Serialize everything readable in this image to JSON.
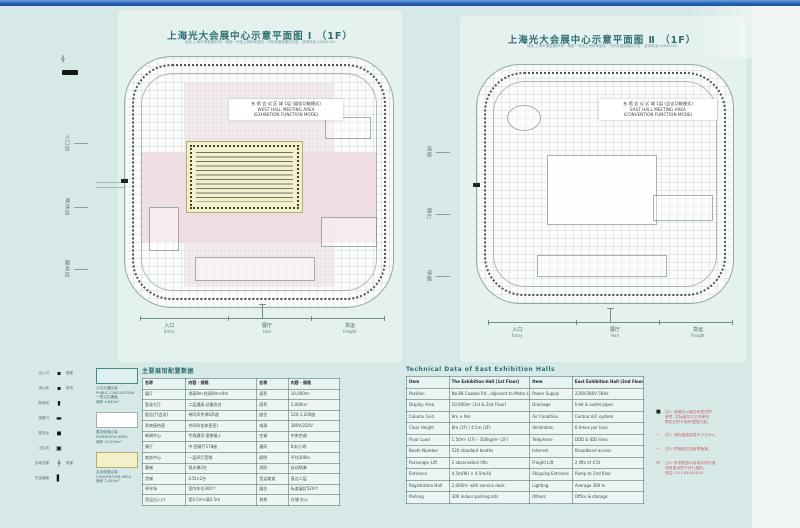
{
  "window": {
    "corner_label": "EF"
  },
  "colors": {
    "paper": "#d7e9e7",
    "title_teal": "#2e6f74",
    "pink_zone": "#eddbe2",
    "yellow_hall": "#f3f0cc",
    "table_line": "#4f7e7e",
    "note_red": "#c4606e",
    "titlebar_blue": "#2b63b5"
  },
  "icons": {
    "scale_bar": "scale-bar",
    "survey_mark": "╬"
  },
  "plans": {
    "left": {
      "title": "上海光大会展中心示意平面图 Ⅰ （1F）",
      "subtitle": "地址:上海市漕宝路88号 · 地铁一号线上海体育馆站 · 内环线漕溪路出口处 · 咨询电话 64842500",
      "note_lines": [
        "东 馆 会 议 区 域 1层 (展览功能模式)",
        "WEST HALL  MEETING AREA",
        "(EXHIBITION FUNCTION MODE)"
      ],
      "axis_labels": [
        {
          "cn": "入口",
          "en": "Entry"
        },
        {
          "cn": "展厅",
          "en": "Hall"
        },
        {
          "cn": "货运",
          "en": "Freight"
        }
      ]
    },
    "right": {
      "title": "上海光大会展中心示意平面图 Ⅱ （1F）",
      "subtitle": "地址:上海市漕宝路88号 · 地铁一号线上海体育馆站 · 内环线漕溪路出口处 · 咨询电话 64842500",
      "note_lines": [
        "东 馆 会 议 区 域 1层 (会议功能模式)",
        "EAST HALL  MEETING AREA",
        "(CONVENTION FUNCTION MODE)"
      ],
      "axis_labels": [
        {
          "cn": "入口",
          "en": "Entry"
        },
        {
          "cn": "展厅",
          "en": "Hall"
        },
        {
          "cn": "货运",
          "en": "Freight"
        }
      ]
    }
  },
  "side_labels": {
    "left_margin": [
      "入口区",
      "通道区",
      "服务区"
    ],
    "between": [
      "连廊",
      "展厅",
      "道路"
    ]
  },
  "legend": {
    "rows": [
      {
        "l": "出入口",
        "s": "▪",
        "r": "楼梯"
      },
      {
        "l": "消火栓",
        "s": "▪",
        "r": "卷帘"
      },
      {
        "l": "配电间",
        "s": "▮",
        "r": ""
      },
      {
        "l": "疏散口",
        "s": "▬",
        "r": ""
      },
      {
        "l": "服务台",
        "s": "◼",
        "r": ""
      },
      {
        "l": "卫生间",
        "s": "▣",
        "r": ""
      },
      {
        "l": "自动扶梯",
        "s": "┼",
        "r": "电梯"
      },
      {
        "l": "货运通道",
        "s": "▌",
        "r": ""
      }
    ],
    "swatches": [
      {
        "color": "#e0f0ee",
        "border": "#3f8a8a",
        "lines": [
          "公共交通区域",
          "PUBLIC CIRCULATION",
          "一层公共通道",
          "面积 4,600m²"
        ]
      },
      {
        "color": "#fcfdfc",
        "border": "#9fb0ae",
        "lines": [
          "展览使用区域",
          "EXHIBITION AREA",
          "面积 10,000m²"
        ]
      },
      {
        "color": "#f3f0cb",
        "border": "#b5ac6c",
        "lines": [
          "会议使用区域",
          "CONVENTION AREA",
          "面积 2,400m²"
        ]
      }
    ]
  },
  "mid_table": {
    "title": "主要展馆配置数据",
    "col_widths": [
      22,
      36,
      16,
      26
    ],
    "header": [
      "名称",
      "内容 · 规格",
      "名称",
      "内容 · 规格"
    ],
    "rows": [
      [
        "展厅",
        "净高8m·柱网9m×9m",
        "面积",
        "10,000m²"
      ],
      [
        "登录大厅",
        "二层通高·总服务台",
        "面积",
        "2,000m²"
      ],
      [
        "报告厅(会议)",
        "带同声传译6声道",
        "座位",
        "120-1,200座"
      ],
      [
        "贵宾接待室",
        "共6间(含休息室)",
        "电源",
        "380V/220V"
      ],
      [
        "新闻中心",
        "专线通讯·宽带接入",
        "空调",
        "中央空调"
      ],
      [
        "餐厅",
        "中·西餐厅178座",
        "通风",
        "6次/小时"
      ],
      [
        "商务中心",
        "一层序厅西侧",
        "照明",
        "平均300lx"
      ],
      [
        "客梯",
        "观光梯2台",
        "消防",
        "自动喷淋"
      ],
      [
        "货梯",
        "4.5t×2台",
        "货运坡道",
        "直达二层"
      ],
      [
        "停车场",
        "室内车位300个",
        "展位",
        "标准展位520个"
      ],
      [
        "货运出入口",
        "宽4.5m×高4.5m",
        "其他",
        "仓储·办公"
      ]
    ]
  },
  "right_table": {
    "title": "Technical Data of East Exhibition Halls",
    "col_widths": [
      18,
      34,
      18,
      30
    ],
    "header": [
      "Item",
      "The Exhibition Hall (1st Floor)",
      "Item",
      "East Exhibition Hall (2nd Floor)"
    ],
    "rows": [
      [
        "Position",
        "No.88 Caobao Rd., adjacent to Metro Line 1",
        "Power Supply",
        "220V/380V 50Hz"
      ],
      [
        "Display Area",
        "10,000m² (1st & 2nd Floor)",
        "Drainage",
        "Inlet & outlet pipes"
      ],
      [
        "Column Grid",
        "9m × 9m",
        "Air Condition",
        "Central A/C system"
      ],
      [
        "Clear Height",
        "8m (1F) / 4.5m (2F)",
        "Ventilation",
        "6 times per hour"
      ],
      [
        "Floor Load",
        "1.5t/m² (1F) · 350kg/m² (2F)",
        "Telephone",
        "DDD & IDD lines"
      ],
      [
        "Booth Number",
        "520 standard booths",
        "Internet",
        "Broadband access"
      ],
      [
        "Passenger Lift",
        "2 observation lifts",
        "Freight Lift",
        "2 lifts of 4.5t"
      ],
      [
        "Entrance",
        "4.5m(W) × 4.5m(H)",
        "Shipping Entrance",
        "Ramp to 2nd floor"
      ],
      [
        "Registration Hall",
        "2,000m² with service desk",
        "Lighting",
        "Average 300 lx"
      ],
      [
        "Parking",
        "300 indoor parking lots",
        "Others",
        "Office & storage"
      ]
    ]
  },
  "notes": [
    {
      "bullet": "■",
      "lines": [
        "注1: 本图所示展位布置仅供",
        "参考, 实际展位以主办单位",
        "审定后的平面布置图为准。"
      ]
    },
    {
      "bullet": "–",
      "lines": [
        "注2: 消防通道宽度不小于3m。"
      ]
    },
    {
      "bullet": "–",
      "lines": [
        "注3: 特装展位须报审备案。"
      ]
    },
    {
      "bullet": "≡",
      "lines": [
        "注4: 技术数据以现场实测为准,",
        "如有变动恕不另行通知。",
        "电话: 021-64842500"
      ]
    }
  ]
}
